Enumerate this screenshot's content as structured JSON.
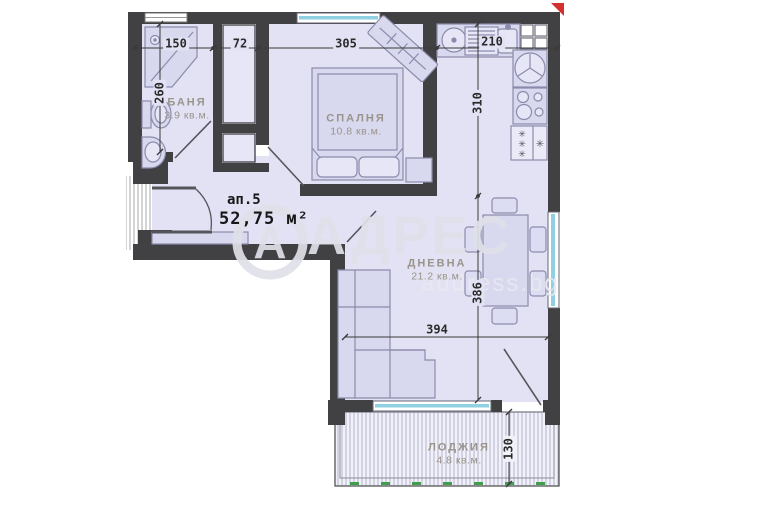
{
  "plan": {
    "apartment": {
      "number_label": "ап.5",
      "total_area": "52,75 м²"
    },
    "rooms": [
      {
        "name": "БАНЯ",
        "area": "3.9 кв.м."
      },
      {
        "name": "СПАЛНЯ",
        "area": "10.8 кв.м."
      },
      {
        "name": "ДНЕВНА",
        "area": "21.2 кв.м."
      },
      {
        "name": "ЛОДЖИЯ",
        "area": "4.8 кв.м."
      }
    ],
    "dims": [
      {
        "name": "bathroom-width",
        "value": "150"
      },
      {
        "name": "closet-width",
        "value": "72"
      },
      {
        "name": "bedroom-width",
        "value": "305"
      },
      {
        "name": "kitchen-width",
        "value": "210"
      },
      {
        "name": "bathroom-depth",
        "value": "260"
      },
      {
        "name": "kitchen-depth",
        "value": "310"
      },
      {
        "name": "living-depth",
        "value": "386"
      },
      {
        "name": "living-width",
        "value": "394"
      },
      {
        "name": "loggia-depth",
        "value": "130"
      }
    ],
    "watermark": {
      "brand": "АДРЕС",
      "logo_letter": "А",
      "site": "address.bg"
    },
    "colors": {
      "wall": "#414144",
      "floor": "#e2e2f4",
      "furniture_fill": "#d8d8ee",
      "furniture_stroke": "#8b8bac",
      "window_glass": "#8fd0e2",
      "north_marker_red": "#d4302e",
      "dim_text": "#2b2b2b",
      "room_label_gray": "#9a948c",
      "watermark_gray": "#e0e0e8",
      "loggia_tick_green": "#3f9f4d"
    }
  }
}
